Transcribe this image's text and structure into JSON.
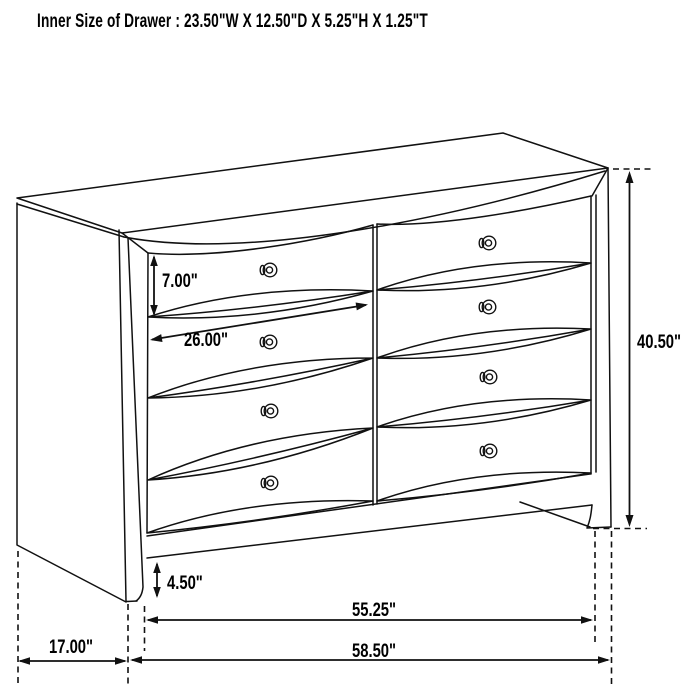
{
  "title": "Inner Size of Drawer : 23.50\"W X 12.50\"D X 5.25\"H X 1.25\"T",
  "dimension_labels": {
    "top_drawer_height": "7.00\"",
    "drawer_front_width": "26.00\"",
    "overall_height": "40.50\"",
    "base_clearance": "4.50\"",
    "feet_span_width": "55.25\"",
    "overall_width": "58.50\"",
    "side_depth": "17.00\""
  },
  "figure": {
    "type": "furniture-dimension-line-drawing",
    "item": "8-drawer dresser, perspective view",
    "drawer_rows": 4,
    "drawer_columns": 2,
    "knob_count": 8
  },
  "colors": {
    "background": "#ffffff",
    "line": "#111111",
    "text": "#000000"
  }
}
